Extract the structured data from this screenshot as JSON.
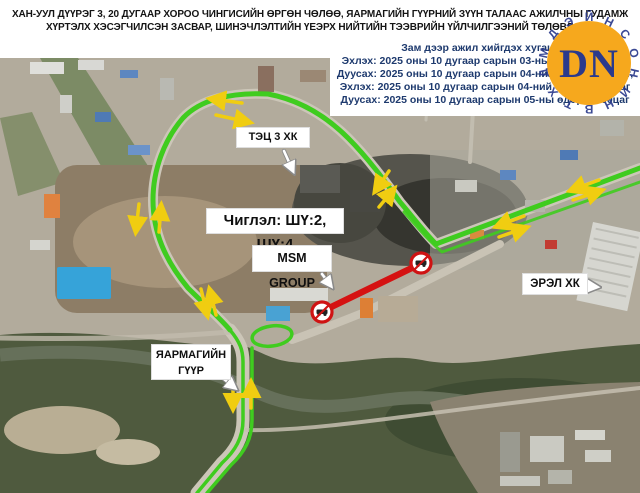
{
  "header": {
    "title_line1": "ХАН-УУЛ ДҮҮРЭГ 3, 20 ДУГААР ХОРОО ЧИНГИСИЙН ӨРГӨН ЧӨЛӨӨ, ЯАРМАГИЙН ГҮҮРНИЙ ЗҮҮН ТАЛААС АЖИЛЧНЫ ГУДАМЖ",
    "title_line2": "ХҮРТЭЛХ ХЭСЭГЧИЛСЭН ЗАСВАР, ШИНЭЧЛЭЛТИЙН ҮЕЭРХ НИЙТИЙН ТЭЭВРИЙН ҮЙЛЧИЛГЭЭНИЙ ТӨЛӨВЛӨЛТ"
  },
  "schedule": {
    "heading": "Зам дээр ажил хийгдэх хугацаа:",
    "lines": [
      "Эхлэх: 2025 оны 10 дугаар сарын 03-ны өдөр 23:00 цаг",
      "Дуусах: 2025 оны 10 дугаар сарын 04-ний өдөр 06:00Цаг,",
      "Эхлэх: 2025 оны 10 дугаар сарын 04-ний өдөр 23:00 цаг",
      "Дуусах: 2025 оны 10 дугаар сарын 05-ны өдөр 06:00цаг"
    ],
    "text_color": "#1e3a6e"
  },
  "logo": {
    "monogram": "DN",
    "circle_color": "#f6a81d",
    "letter_color": "#2b3a8c",
    "ring_letters": [
      "Й",
      "Н",
      "С",
      "О",
      "Н",
      "И",
      "Н",
      "В",
      "Т",
      "Х",
      "Д",
      "М",
      "Д",
      "Э"
    ]
  },
  "map_labels": {
    "tec3": "ТЭЦ 3 ХК",
    "direction": "Чиглэл: ШҮ:2, ШҮ:4",
    "msm": "MSM GROUP",
    "erel": "ЭРЭЛ ХК",
    "bridge_line1": "ЯАРМАГИЙН",
    "bridge_line2": "ГҮҮР"
  },
  "legend_colors": {
    "open_route_green": "#3fcc1f",
    "closed_segment_red": "#d51212",
    "direction_arrow_yellow": "#f0cd11"
  }
}
